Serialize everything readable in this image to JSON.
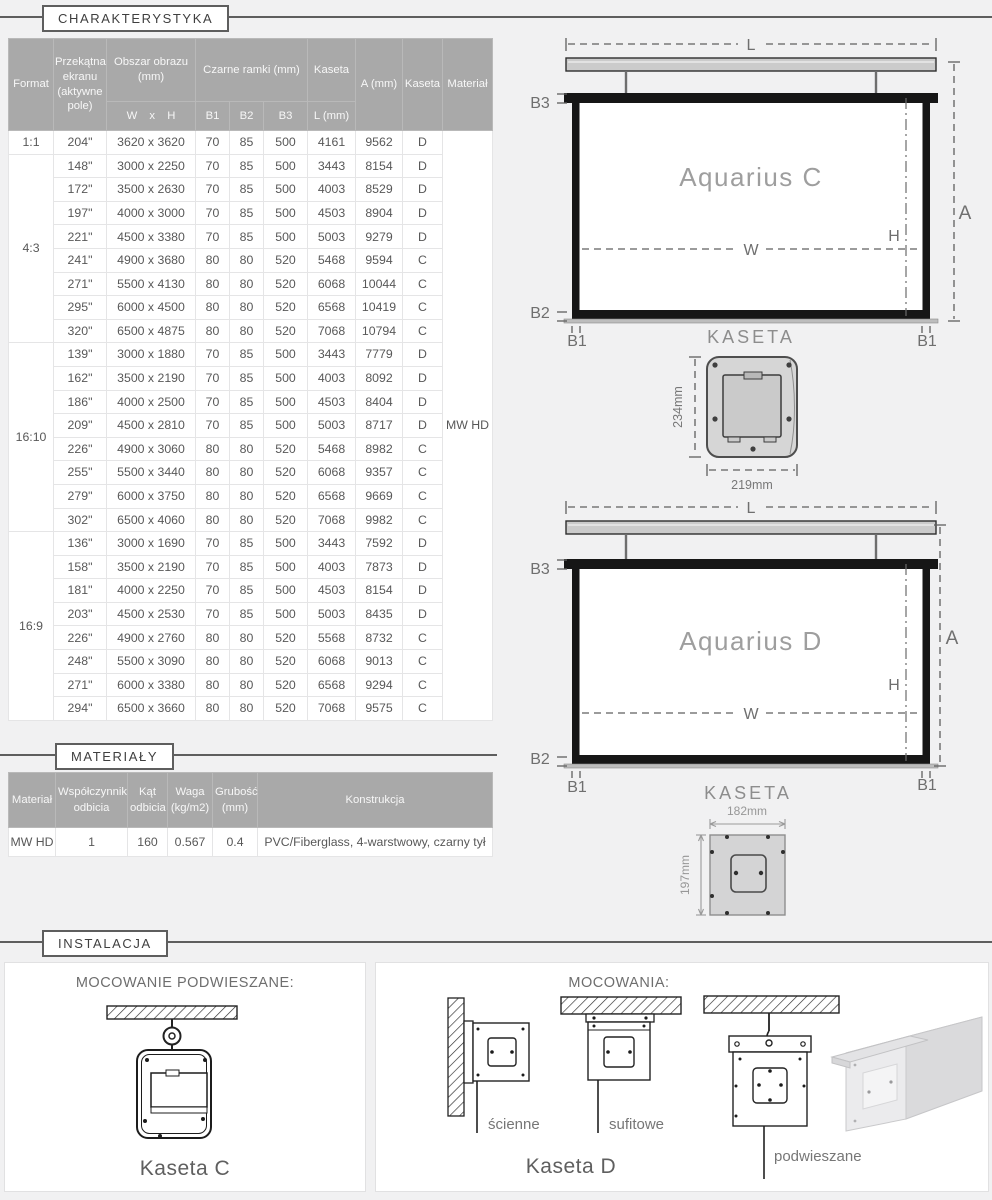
{
  "sections": {
    "charakterystyka": "CHARAKTERYSTYKA",
    "materialy": "MATERIAŁY",
    "instalacja": "INSTALACJA"
  },
  "colors": {
    "page_bg": "#f1f1f2",
    "table_header_bg": "#a9a9a9",
    "screen_frame": "#161616",
    "cassette_gray": "#cbcbcb"
  },
  "spec_table": {
    "header": {
      "format": "Format",
      "diagonal": "Przekątna ekranu (aktywne pole)",
      "image_area": "Obszar obrazu (mm)",
      "wxh": "W x H",
      "borders": "Czarne ramki (mm)",
      "b1": "B1",
      "b2": "B2",
      "b3": "B3",
      "kaseta": "Kaseta",
      "l_mm": "L (mm)",
      "a_mm": "A (mm)",
      "kaseta_type": "Kaseta",
      "material": "Materiał"
    },
    "material_value": "MW HD",
    "groups": [
      {
        "format": "1:1",
        "rows": [
          {
            "size": "204\"",
            "area": "3620 x 3620",
            "b1": "70",
            "b2": "85",
            "b3": "500",
            "l": "4161",
            "a": "9562",
            "kaseta": "D"
          }
        ]
      },
      {
        "format": "4:3",
        "rows": [
          {
            "size": "148\"",
            "area": "3000 x 2250",
            "b1": "70",
            "b2": "85",
            "b3": "500",
            "l": "3443",
            "a": "8154",
            "kaseta": "D"
          },
          {
            "size": "172\"",
            "area": "3500 x 2630",
            "b1": "70",
            "b2": "85",
            "b3": "500",
            "l": "4003",
            "a": "8529",
            "kaseta": "D"
          },
          {
            "size": "197\"",
            "area": "4000 x 3000",
            "b1": "70",
            "b2": "85",
            "b3": "500",
            "l": "4503",
            "a": "8904",
            "kaseta": "D"
          },
          {
            "size": "221\"",
            "area": "4500 x 3380",
            "b1": "70",
            "b2": "85",
            "b3": "500",
            "l": "5003",
            "a": "9279",
            "kaseta": "D"
          },
          {
            "size": "241\"",
            "area": "4900 x 3680",
            "b1": "80",
            "b2": "80",
            "b3": "520",
            "l": "5468",
            "a": "9594",
            "kaseta": "C"
          },
          {
            "size": "271\"",
            "area": "5500 x 4130",
            "b1": "80",
            "b2": "80",
            "b3": "520",
            "l": "6068",
            "a": "10044",
            "kaseta": "C"
          },
          {
            "size": "295\"",
            "area": "6000 x 4500",
            "b1": "80",
            "b2": "80",
            "b3": "520",
            "l": "6568",
            "a": "10419",
            "kaseta": "C"
          },
          {
            "size": "320\"",
            "area": "6500 x 4875",
            "b1": "80",
            "b2": "80",
            "b3": "520",
            "l": "7068",
            "a": "10794",
            "kaseta": "C"
          }
        ]
      },
      {
        "format": "16:10",
        "rows": [
          {
            "size": "139\"",
            "area": "3000 x 1880",
            "b1": "70",
            "b2": "85",
            "b3": "500",
            "l": "3443",
            "a": "7779",
            "kaseta": "D"
          },
          {
            "size": "162\"",
            "area": "3500 x 2190",
            "b1": "70",
            "b2": "85",
            "b3": "500",
            "l": "4003",
            "a": "8092",
            "kaseta": "D"
          },
          {
            "size": "186\"",
            "area": "4000 x 2500",
            "b1": "70",
            "b2": "85",
            "b3": "500",
            "l": "4503",
            "a": "8404",
            "kaseta": "D"
          },
          {
            "size": "209\"",
            "area": "4500 x 2810",
            "b1": "70",
            "b2": "85",
            "b3": "500",
            "l": "5003",
            "a": "8717",
            "kaseta": "D"
          },
          {
            "size": "226\"",
            "area": "4900 x 3060",
            "b1": "80",
            "b2": "80",
            "b3": "520",
            "l": "5468",
            "a": "8982",
            "kaseta": "C"
          },
          {
            "size": "255\"",
            "area": "5500 x 3440",
            "b1": "80",
            "b2": "80",
            "b3": "520",
            "l": "6068",
            "a": "9357",
            "kaseta": "C"
          },
          {
            "size": "279\"",
            "area": "6000 x 3750",
            "b1": "80",
            "b2": "80",
            "b3": "520",
            "l": "6568",
            "a": "9669",
            "kaseta": "C"
          },
          {
            "size": "302\"",
            "area": "6500 x 4060",
            "b1": "80",
            "b2": "80",
            "b3": "520",
            "l": "7068",
            "a": "9982",
            "kaseta": "C"
          }
        ]
      },
      {
        "format": "16:9",
        "rows": [
          {
            "size": "136\"",
            "area": "3000 x 1690",
            "b1": "70",
            "b2": "85",
            "b3": "500",
            "l": "3443",
            "a": "7592",
            "kaseta": "D"
          },
          {
            "size": "158\"",
            "area": "3500 x 2190",
            "b1": "70",
            "b2": "85",
            "b3": "500",
            "l": "4003",
            "a": "7873",
            "kaseta": "D"
          },
          {
            "size": "181\"",
            "area": "4000 x 2250",
            "b1": "70",
            "b2": "85",
            "b3": "500",
            "l": "4503",
            "a": "8154",
            "kaseta": "D"
          },
          {
            "size": "203\"",
            "area": "4500 x 2530",
            "b1": "70",
            "b2": "85",
            "b3": "500",
            "l": "5003",
            "a": "8435",
            "kaseta": "D"
          },
          {
            "size": "226\"",
            "area": "4900 x 2760",
            "b1": "80",
            "b2": "80",
            "b3": "520",
            "l": "5568",
            "a": "8732",
            "kaseta": "C"
          },
          {
            "size": "248\"",
            "area": "5500 x 3090",
            "b1": "80",
            "b2": "80",
            "b3": "520",
            "l": "6068",
            "a": "9013",
            "kaseta": "C"
          },
          {
            "size": "271\"",
            "area": "6000 x 3380",
            "b1": "80",
            "b2": "80",
            "b3": "520",
            "l": "6568",
            "a": "9294",
            "kaseta": "C"
          },
          {
            "size": "294\"",
            "area": "6500 x 3660",
            "b1": "80",
            "b2": "80",
            "b3": "520",
            "l": "7068",
            "a": "9575",
            "kaseta": "C"
          }
        ]
      }
    ]
  },
  "materials_table": {
    "header": {
      "material": "Materiał",
      "reflection": "Współczynnik odbicia",
      "angle": "Kąt odbicia",
      "weight": "Waga (kg/m2)",
      "thickness": "Grubość (mm)",
      "construction": "Konstrukcja"
    },
    "row": {
      "material": "MW HD",
      "reflection": "1",
      "angle": "160",
      "weight": "0.567",
      "thickness": "0.4",
      "construction": "PVC/Fiberglass, 4-warstwowy, czarny tył"
    }
  },
  "diagrams": {
    "aquarius_c": {
      "title": "Aquarius C",
      "l": "L",
      "a": "A",
      "h": "H",
      "w": "W",
      "b1": "B1",
      "b2": "B2",
      "b3": "B3",
      "kaseta": "KASETA",
      "cross_height": "234mm",
      "cross_width": "219mm"
    },
    "aquarius_d": {
      "title": "Aquarius D",
      "l": "L",
      "a": "A",
      "h": "H",
      "w": "W",
      "b1": "B1",
      "b2": "B2",
      "b3": "B3",
      "kaseta": "KASETA",
      "cross_width": "182mm",
      "cross_height": "197mm"
    }
  },
  "installation": {
    "left": {
      "title": "MOCOWANIE PODWIESZANE:",
      "caption": "Kaseta C"
    },
    "right": {
      "title": "MOCOWANIA:",
      "wall_label": "ścienne",
      "ceiling_label": "sufitowe",
      "suspended_label": "podwieszane",
      "caption": "Kaseta D"
    }
  }
}
